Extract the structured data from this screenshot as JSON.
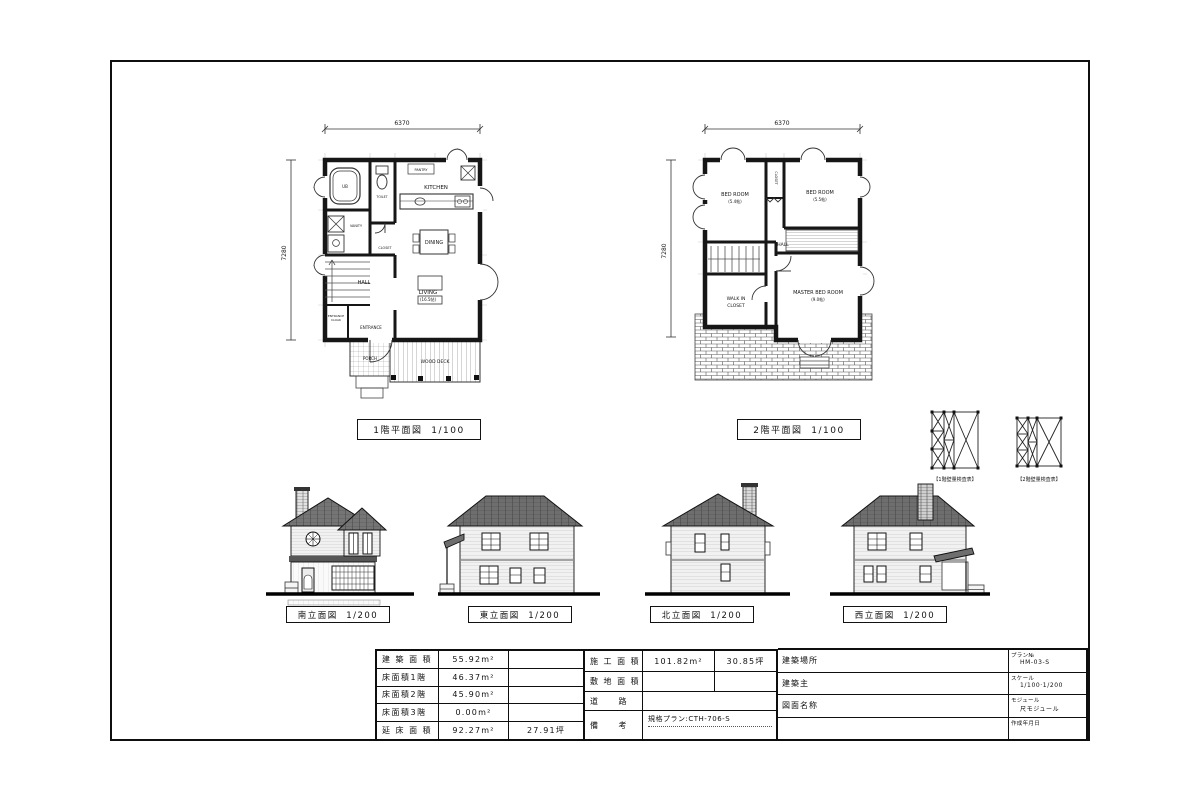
{
  "captions": {
    "plan1": "1階平面図  1/100",
    "plan2": "2階平面図  1/100",
    "elev_south": "南立面図  1/200",
    "elev_east": "東立面図  1/200",
    "elev_north": "北立面図  1/200",
    "elev_west": "西立面図  1/200",
    "wall_diagram_1f": "【1階壁量検査表】",
    "wall_diagram_2f": "【2階壁量検査表】"
  },
  "plan1": {
    "dim_width": "6370",
    "dim_height": "7280",
    "rooms": {
      "kitchen": "KITCHEN",
      "pantry": "PANTRY",
      "dining": "DINING",
      "living": "LIVING",
      "living_size": "(16.5帖)",
      "hall": "HALL",
      "closet": "CLOSET",
      "entrance": "ENTRANCE",
      "cloak_1": "ENTRANCE",
      "cloak_2": "CLOAK",
      "porch": "PORCH",
      "wood_deck": "WOOD DECK",
      "bath": "UB",
      "vanity": "VANITY",
      "toilet": "TOILET"
    }
  },
  "plan2": {
    "dim_width": "6370",
    "dim_height": "7280",
    "rooms": {
      "bedroom1": "BED ROOM",
      "bedroom1_size": "(5.4帖)",
      "bedroom2": "BED ROOM",
      "bedroom2_size": "(5.5帖)",
      "closet": "CLOSET",
      "hall": "HALL",
      "walkin_1": "WALK IN",
      "walkin_2": "CLOSET",
      "master": "MASTER BED ROOM",
      "master_size": "(9.0帖)"
    }
  },
  "area_table": {
    "rows": [
      {
        "label": "建 築 面 積",
        "sqm": "55.92m²",
        "tsubo": ""
      },
      {
        "label": "床面積1階",
        "sqm": "46.37m²",
        "tsubo": ""
      },
      {
        "label": "床面積2階",
        "sqm": "45.90m²",
        "tsubo": ""
      },
      {
        "label": "床面積3階",
        "sqm": "0.00m²",
        "tsubo": ""
      },
      {
        "label": "延 床 面 積",
        "sqm": "92.27m²",
        "tsubo": "27.91坪"
      }
    ]
  },
  "construction_table": {
    "r1_label": "施 工 面 積",
    "r1_sqm": "101.82m²",
    "r1_tsubo": "30.85坪",
    "r2_label": "敷 地 面 積",
    "r3_label": "道　　路",
    "r4_label": "備　　考",
    "r4_remark": "規格プラン:CTH-706-S"
  },
  "title_block": {
    "r1_label": "建築場所",
    "r2_label": "建築主",
    "r3_label": "図面名称",
    "r4_label": "",
    "meta1_label": "プラン№",
    "meta1_value": "HM-03-S",
    "meta2_label": "スケール",
    "meta2_value": "1/100·1/200",
    "meta3_label": "モジュール",
    "meta3_value": "尺モジュール",
    "meta4_label": "作成年月日",
    "meta4_value": ""
  }
}
